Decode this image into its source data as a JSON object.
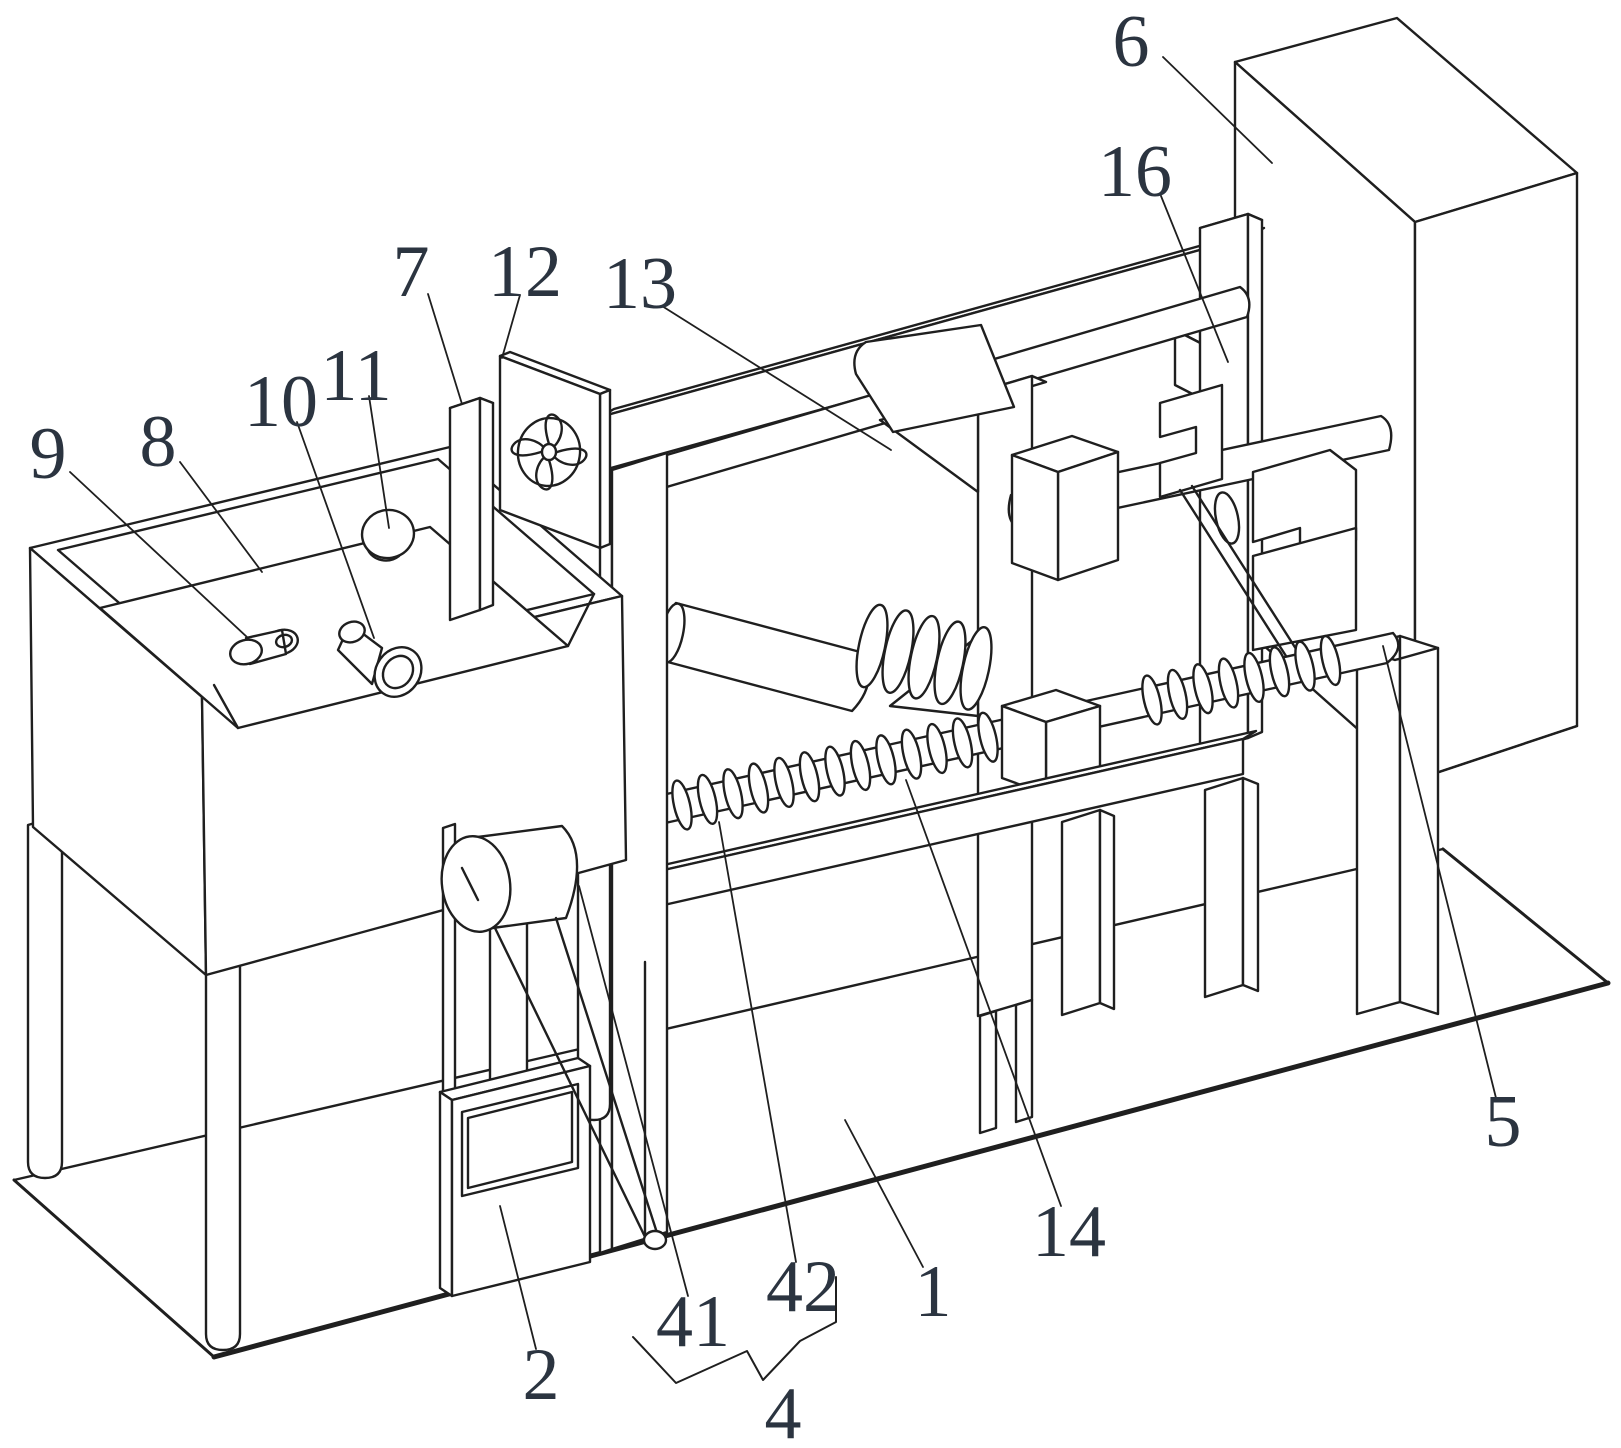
{
  "figure": {
    "kind": "patent-isometric-line-drawing",
    "canvas": {
      "width": 1621,
      "height": 1448
    },
    "background_color": "#ffffff",
    "ink_color": "#1f1f1f",
    "label_color": "#2b3440"
  },
  "labels": [
    {
      "id": "9",
      "text": "9",
      "x": 48,
      "y": 452,
      "leader": [
        [
          70,
          472
        ],
        [
          248,
          638
        ]
      ]
    },
    {
      "id": "8",
      "text": "8",
      "x": 158,
      "y": 440,
      "leader": [
        [
          180,
          462
        ],
        [
          262,
          572
        ]
      ]
    },
    {
      "id": "10",
      "text": "10",
      "x": 281,
      "y": 400,
      "leader": [
        [
          297,
          422
        ],
        [
          374,
          638
        ]
      ]
    },
    {
      "id": "11",
      "text": "11",
      "x": 356,
      "y": 374,
      "leader": [
        [
          369,
          396
        ],
        [
          389,
          528
        ]
      ]
    },
    {
      "id": "7",
      "text": "7",
      "x": 411,
      "y": 270,
      "leader": [
        [
          428,
          294
        ],
        [
          462,
          404
        ]
      ]
    },
    {
      "id": "12",
      "text": "12",
      "x": 525,
      "y": 270,
      "leader": [
        [
          520,
          295
        ],
        [
          502,
          358
        ]
      ]
    },
    {
      "id": "13",
      "text": "13",
      "x": 640,
      "y": 282,
      "leader": [
        [
          662,
          306
        ],
        [
          891,
          450
        ]
      ]
    },
    {
      "id": "6",
      "text": "6",
      "x": 1131,
      "y": 40,
      "leader": [
        [
          1163,
          57
        ],
        [
          1272,
          163
        ]
      ]
    },
    {
      "id": "16",
      "text": "16",
      "x": 1135,
      "y": 170,
      "leader": [
        [
          1161,
          196
        ],
        [
          1228,
          362
        ]
      ]
    },
    {
      "id": "5",
      "text": "5",
      "x": 1503,
      "y": 1120,
      "leader": [
        [
          1496,
          1098
        ],
        [
          1383,
          646
        ]
      ]
    },
    {
      "id": "14",
      "text": "14",
      "x": 1069,
      "y": 1230,
      "leader": [
        [
          1061,
          1206
        ],
        [
          906,
          780
        ]
      ]
    },
    {
      "id": "1",
      "text": "1",
      "x": 933,
      "y": 1290,
      "leader": [
        [
          923,
          1267
        ],
        [
          845,
          1120
        ]
      ]
    },
    {
      "id": "42",
      "text": "42",
      "x": 803,
      "y": 1285,
      "leader": [
        [
          796,
          1262
        ],
        [
          719,
          822
        ]
      ]
    },
    {
      "id": "41",
      "text": "41",
      "x": 693,
      "y": 1320,
      "leader": [
        [
          688,
          1296
        ],
        [
          579,
          886
        ]
      ]
    },
    {
      "id": "2",
      "text": "2",
      "x": 541,
      "y": 1373,
      "leader": [
        [
          536,
          1349
        ],
        [
          500,
          1206
        ]
      ]
    },
    {
      "id": "4",
      "text": "4",
      "x": 783,
      "y": 1412,
      "leader": null
    }
  ],
  "group_brace_4": {
    "points": [
      [
        633,
        1337
      ],
      [
        676,
        1383
      ],
      [
        747,
        1351
      ],
      [
        763,
        1380
      ],
      [
        800,
        1341
      ],
      [
        836,
        1322
      ],
      [
        836,
        1277
      ]
    ]
  }
}
